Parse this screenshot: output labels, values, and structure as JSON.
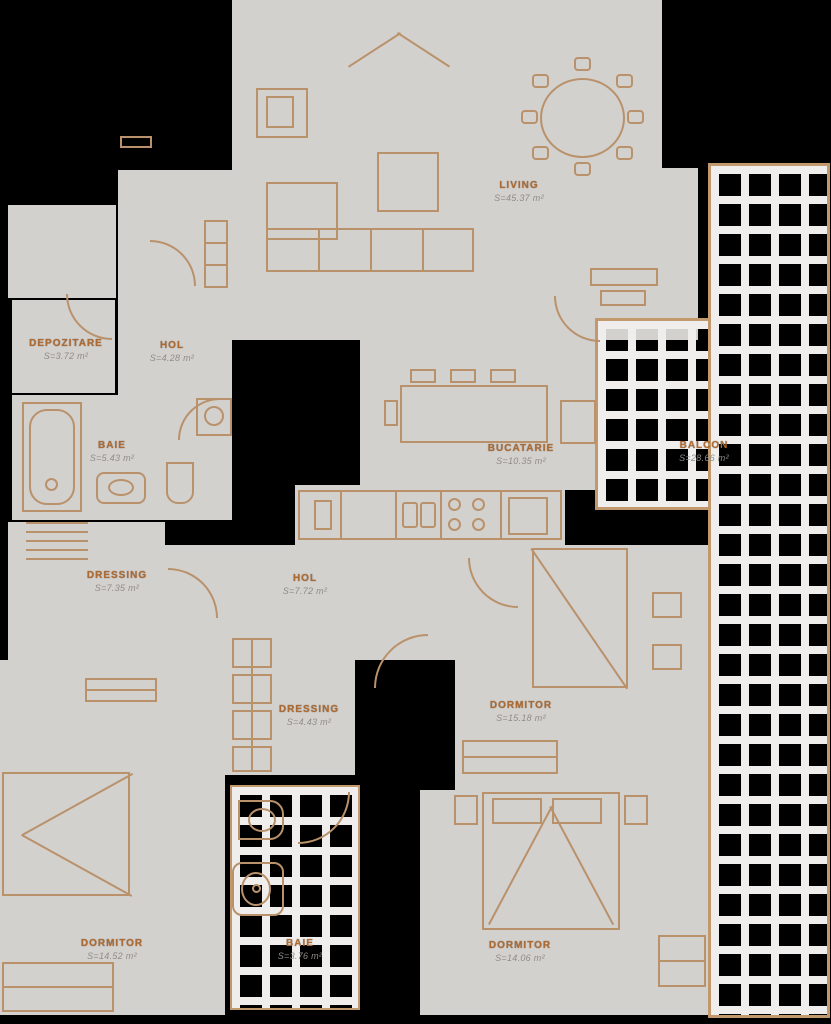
{
  "plan_type": "apartment-floor-plan",
  "colors": {
    "background": "#000000",
    "floor": "#d3d1ce",
    "furniture_outline": "#b9916b",
    "balcony_frame": "#c1996d",
    "tile_line": "#efeeec",
    "room_label": "#ad6a31",
    "area_text": "#8f8c88"
  },
  "rooms": [
    {
      "name": "LIVING",
      "area": "S=45.37 m²"
    },
    {
      "name": "DEPOZITARE",
      "area": "S=3.72 m²"
    },
    {
      "name": "HOL",
      "area": "S=4.28 m²"
    },
    {
      "name": "BAIE",
      "area": "S=5.43 m²"
    },
    {
      "name": "BUCATARIE",
      "area": "S=10.35 m²"
    },
    {
      "name": "BALCON",
      "area": "S=28.66 m²"
    },
    {
      "name": "DRESSING",
      "area": "S=7.35 m²"
    },
    {
      "name": "HOL",
      "area": "S=7.72 m²"
    },
    {
      "name": "DRESSING",
      "area": "S=4.43 m²"
    },
    {
      "name": "DORMITOR",
      "area": "S=15.18 m²"
    },
    {
      "name": "DORMITOR",
      "area": "S=14.52 m²"
    },
    {
      "name": "BAIE",
      "area": "S=3.76 m²"
    },
    {
      "name": "DORMITOR",
      "area": "S=14.06 m²"
    }
  ]
}
